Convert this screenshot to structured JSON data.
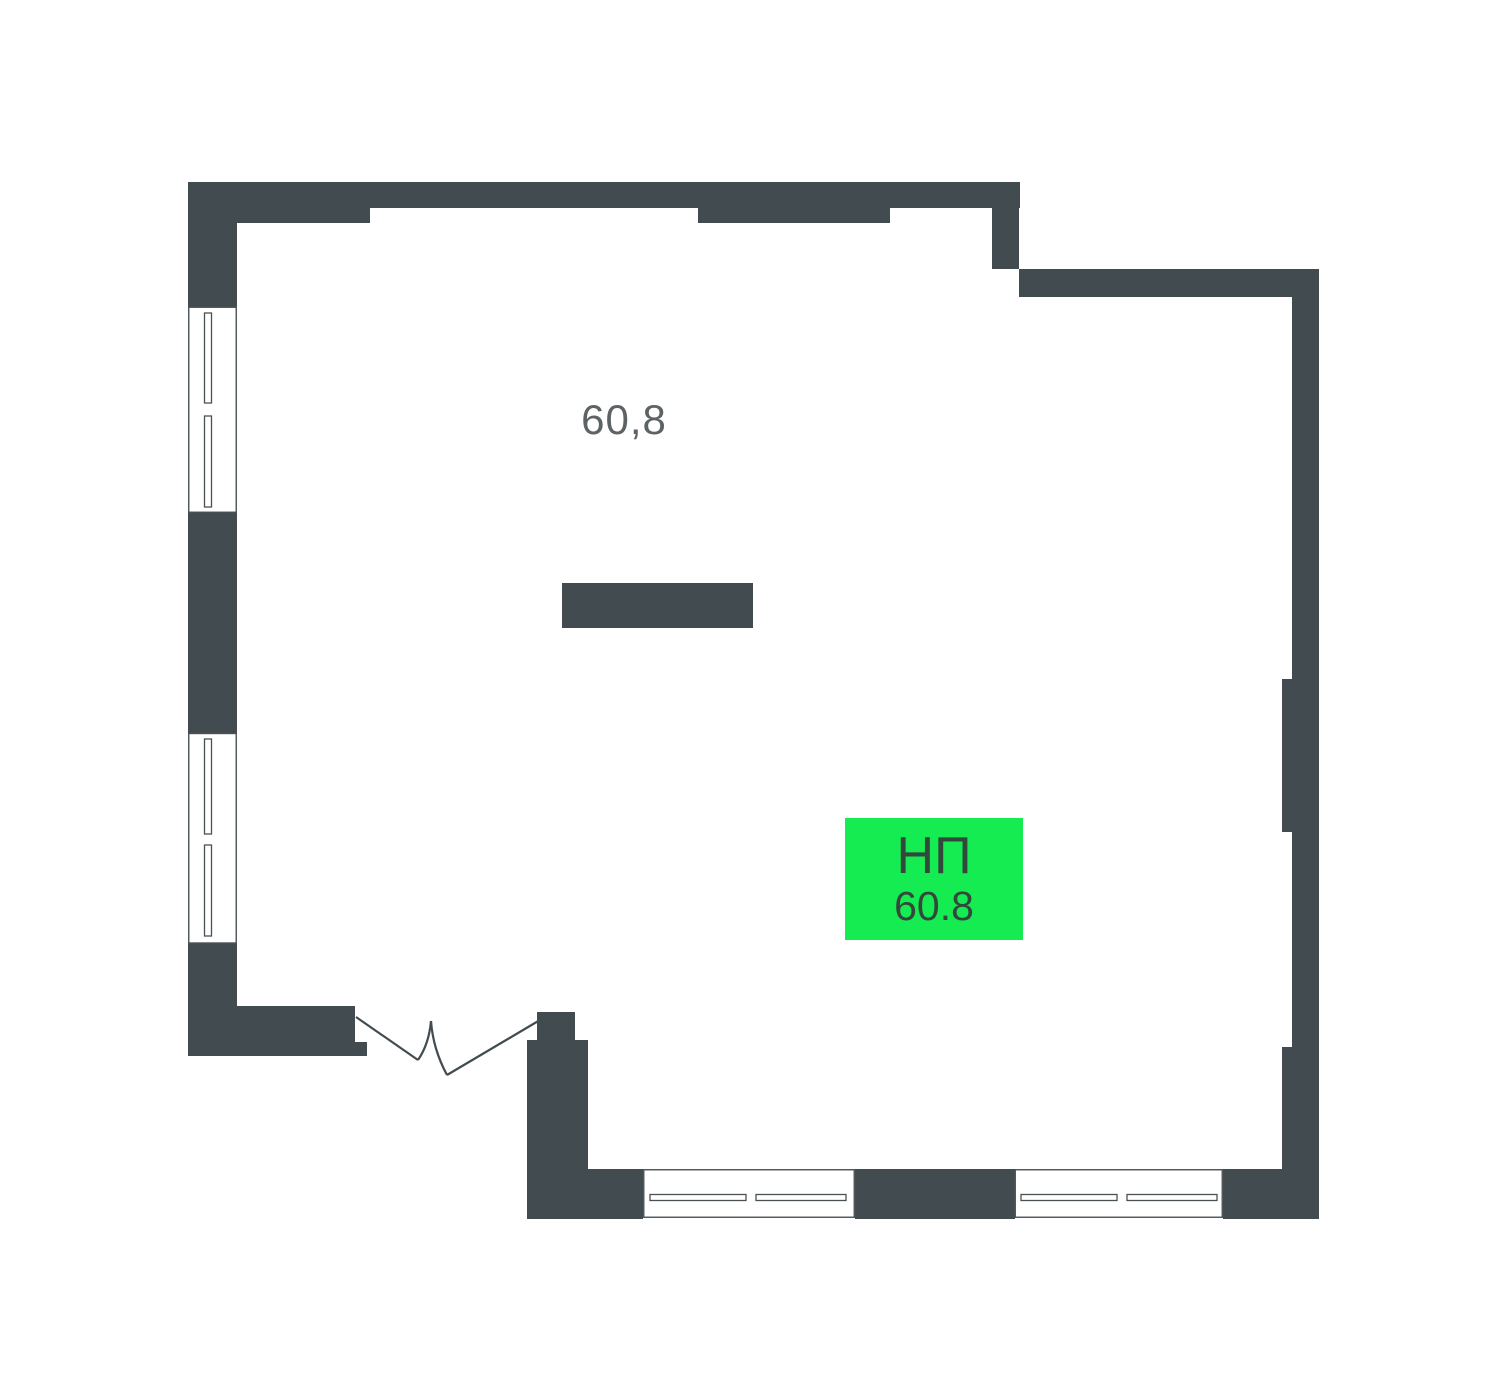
{
  "colors": {
    "wall": "#424b50",
    "frame-line": "#4a5155",
    "door-line": "#424b50",
    "label-text": "#5d6365",
    "badge-bg": "#15ec51",
    "badge-text": "#32483c"
  },
  "plan": {
    "area_label": "60,8",
    "badge": {
      "type_label": "НП",
      "area_value": "60.8"
    }
  }
}
